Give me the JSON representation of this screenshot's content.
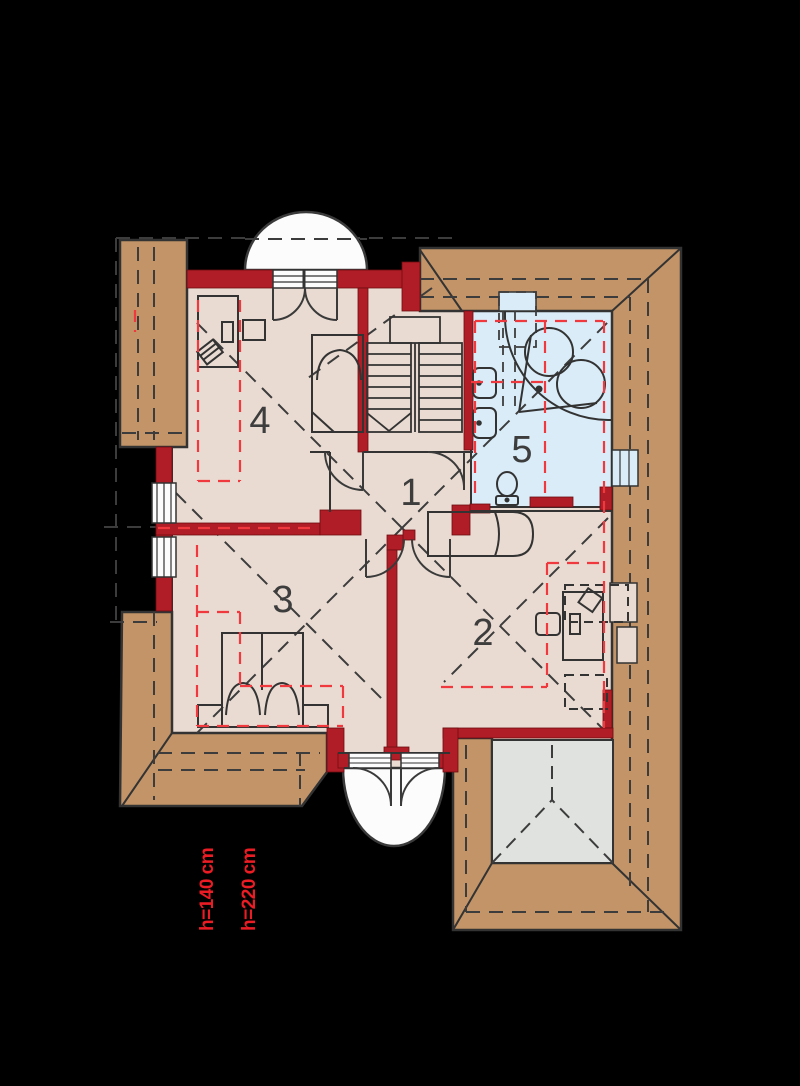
{
  "title": "Attic floor plan",
  "room_labels": {
    "r1": "1",
    "r2": "2",
    "r3": "3",
    "r4": "4",
    "r5": "5"
  },
  "height_annotations": {
    "h140": "h=140 cm",
    "h220": "h=220 cm"
  },
  "colors": {
    "background": "#000000",
    "roof_tan": "#C39467",
    "floor_pink": "#E9DBD2",
    "bathroom_blue": "#D9ECF8",
    "lower_roof_gray": "#DFE2DF",
    "wall_red": "#B01D26",
    "dashed_red": "#F0383F",
    "line_dark": "#333333",
    "balcony_white": "#FCFCFC",
    "annotation_red": "#EC1C24"
  }
}
